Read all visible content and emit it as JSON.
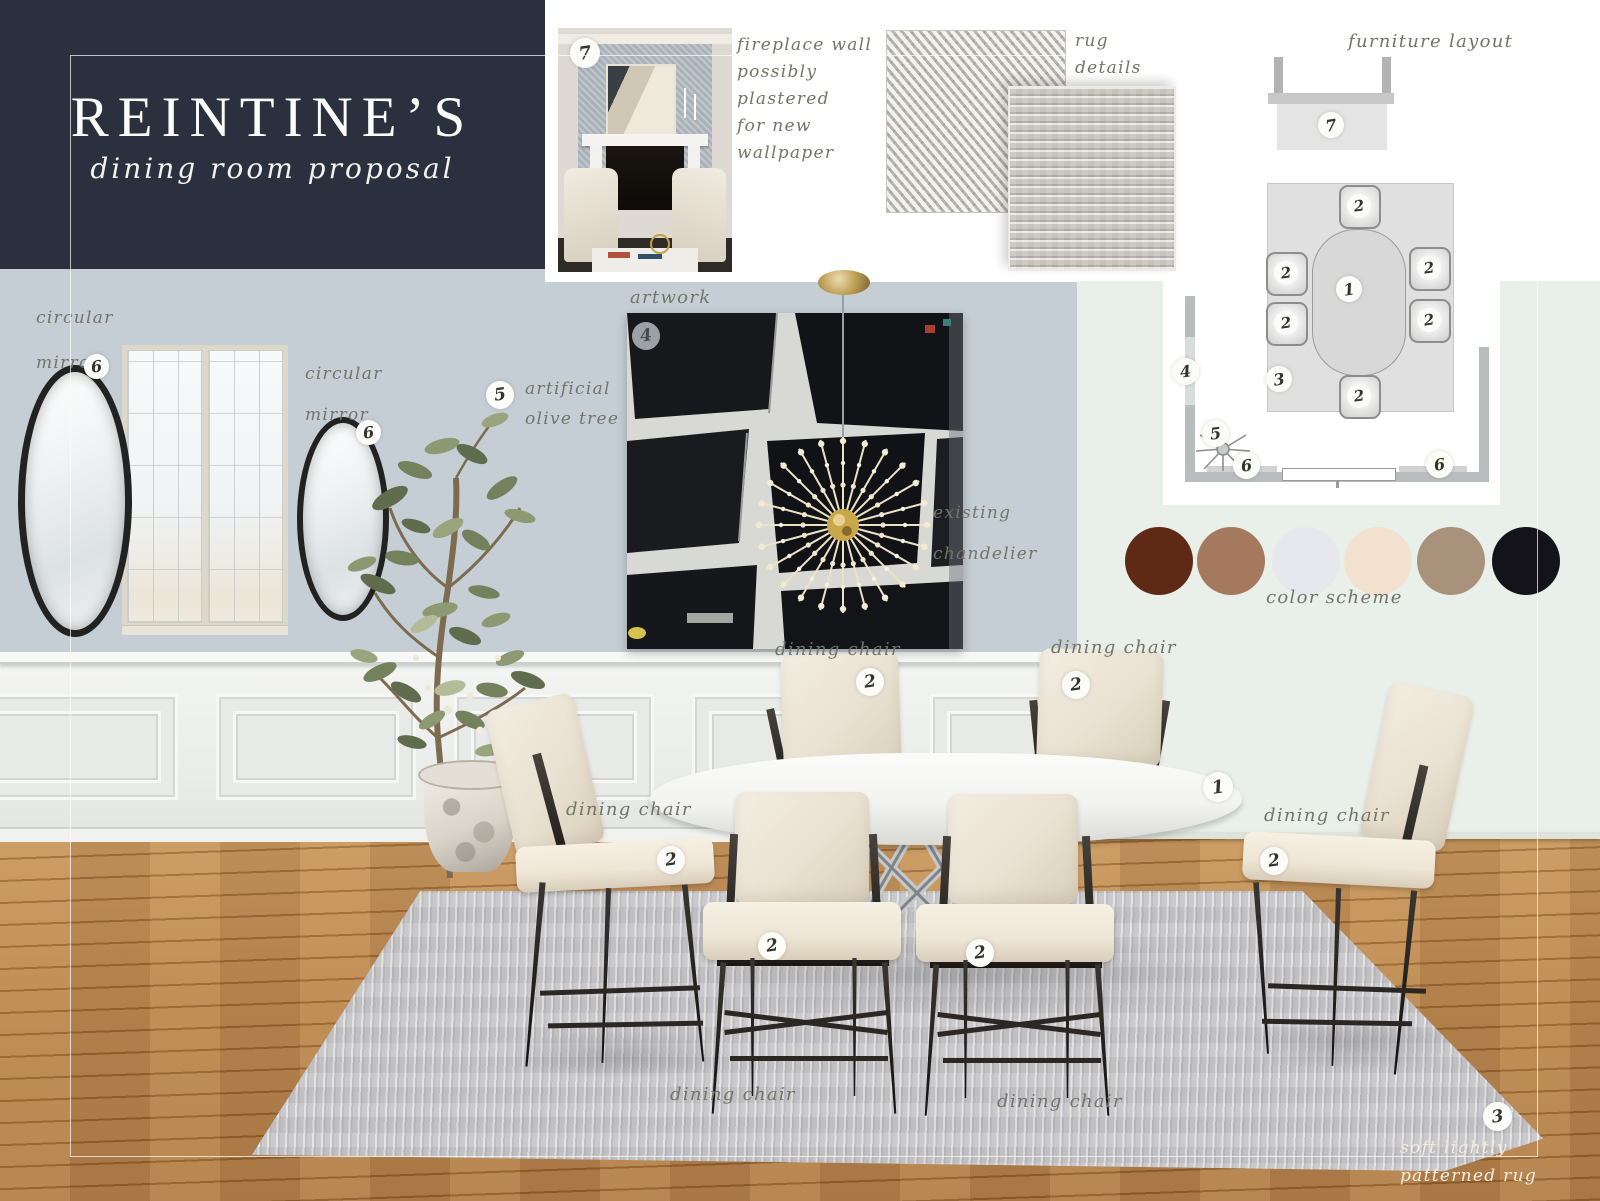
{
  "title": {
    "brand": "REINTINE’S",
    "subtitle": "dining room proposal"
  },
  "annotations": {
    "fireplace_note": [
      "fireplace wall",
      "possibly",
      "plastered",
      "for new",
      "wallpaper"
    ],
    "rug_note": [
      "rug",
      "details"
    ],
    "furniture_layout": "furniture layout",
    "artwork": "artwork",
    "olive_tree": [
      "artificial",
      "olive tree"
    ],
    "circular_mirror": [
      "circular",
      "mirror"
    ],
    "chandelier": [
      "existing",
      "chandelier"
    ],
    "dining_chair": "dining chair",
    "color_scheme": "color scheme",
    "rug_caption": [
      "soft lightly",
      "patterned rug"
    ]
  },
  "badges": {
    "table": "1",
    "chair": "2",
    "rug": "3",
    "artwork": "4",
    "olive_tree": "5",
    "mirror": "6",
    "fireplace": "7"
  },
  "palette": {
    "swatches": [
      {
        "name": "dark chestnut",
        "hex": "#5e2a16"
      },
      {
        "name": "clay brown",
        "hex": "#a5795d"
      },
      {
        "name": "pale lilac gray",
        "hex": "#e7e7ee"
      },
      {
        "name": "cream",
        "hex": "#f3e1d0"
      },
      {
        "name": "taupe",
        "hex": "#a8927b"
      },
      {
        "name": "near black",
        "hex": "#14131a"
      }
    ]
  },
  "colors": {
    "navy": "#2a303e",
    "wall_blue": "#c5ced4",
    "wall_green": "#e9efe9",
    "wood": "#b37d41",
    "rug": "#c7c7c9",
    "accent_gold": "#c9a84c",
    "script_ink": "#73756a"
  }
}
